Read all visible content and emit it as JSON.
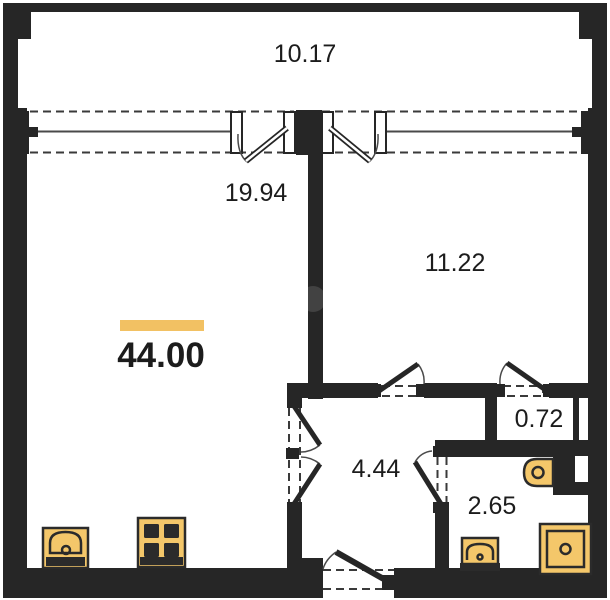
{
  "floor_plan": {
    "title": "one-room apartment floor plan",
    "total_area": "44.00",
    "rooms": {
      "balcony": "10.17",
      "living_room": "19.94",
      "bedroom": "11.22",
      "hallway": "4.44",
      "closet": "0.72",
      "bathroom": "2.65"
    },
    "fixtures": [
      "kitchen-sink",
      "stove",
      "bathroom-sink",
      "toilet",
      "washing-machine"
    ],
    "colors": {
      "wall": "#262626",
      "accent_bar": "#f2c163",
      "fixture_fill": "#f4c76a",
      "fixture_stroke": "#2b2b2b"
    }
  }
}
